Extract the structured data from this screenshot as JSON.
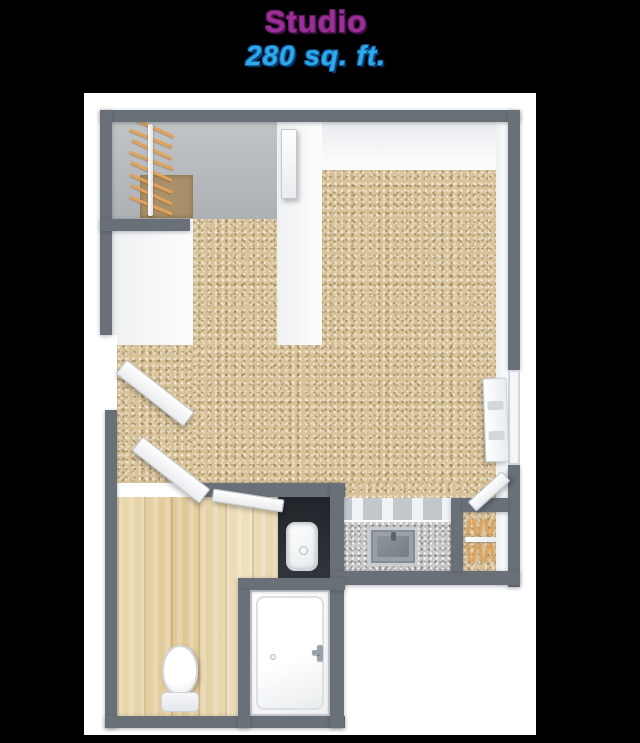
{
  "header": {
    "title": "Studio",
    "subtitle": "280 sq. ft."
  },
  "colors": {
    "background": "#000000",
    "card": "#ffffff",
    "title_purple": "#9c2e98",
    "subtitle_blue": "#2ea9ea",
    "wall_gray": "#6a7078",
    "vanity_dark": "#24272c",
    "carpet_tan": "#d7c299",
    "wood_floor": "#e7d5a9",
    "closet_floor_gray": "#b7babd",
    "rug_brown": "#aa9069",
    "hanger_wood": "#dfa35e",
    "stainless": "#99a0a6"
  },
  "floorplan": {
    "unit_type": "Studio apartment 3D floor plan, top-down view",
    "area_label": "280 sq. ft.",
    "rooms": [
      {
        "id": "main-room",
        "floor": "tan carpet"
      },
      {
        "id": "bathroom",
        "floor": "light wood planks"
      },
      {
        "id": "walk-in-closet-top-left",
        "floor": "gray with brown rug"
      },
      {
        "id": "closet-bottom-right",
        "floor": "tan carpet"
      },
      {
        "id": "kitchenette",
        "floor": "speckled gray countertop"
      }
    ],
    "fixtures": [
      "wardrobe rod with wooden hangers (top-left closet)",
      "wardrobe rod with wooden hangers (bottom-right closet)",
      "entry double doors (left wall, open)",
      "bathroom door (open)",
      "closet door (open)",
      "walk-in closet door",
      "toilet",
      "dark vanity with white vessel sink",
      "bathtub with faucet",
      "stainless kitchen sink in counter",
      "upper cabinets over counter",
      "window with radiator (right wall)"
    ]
  }
}
